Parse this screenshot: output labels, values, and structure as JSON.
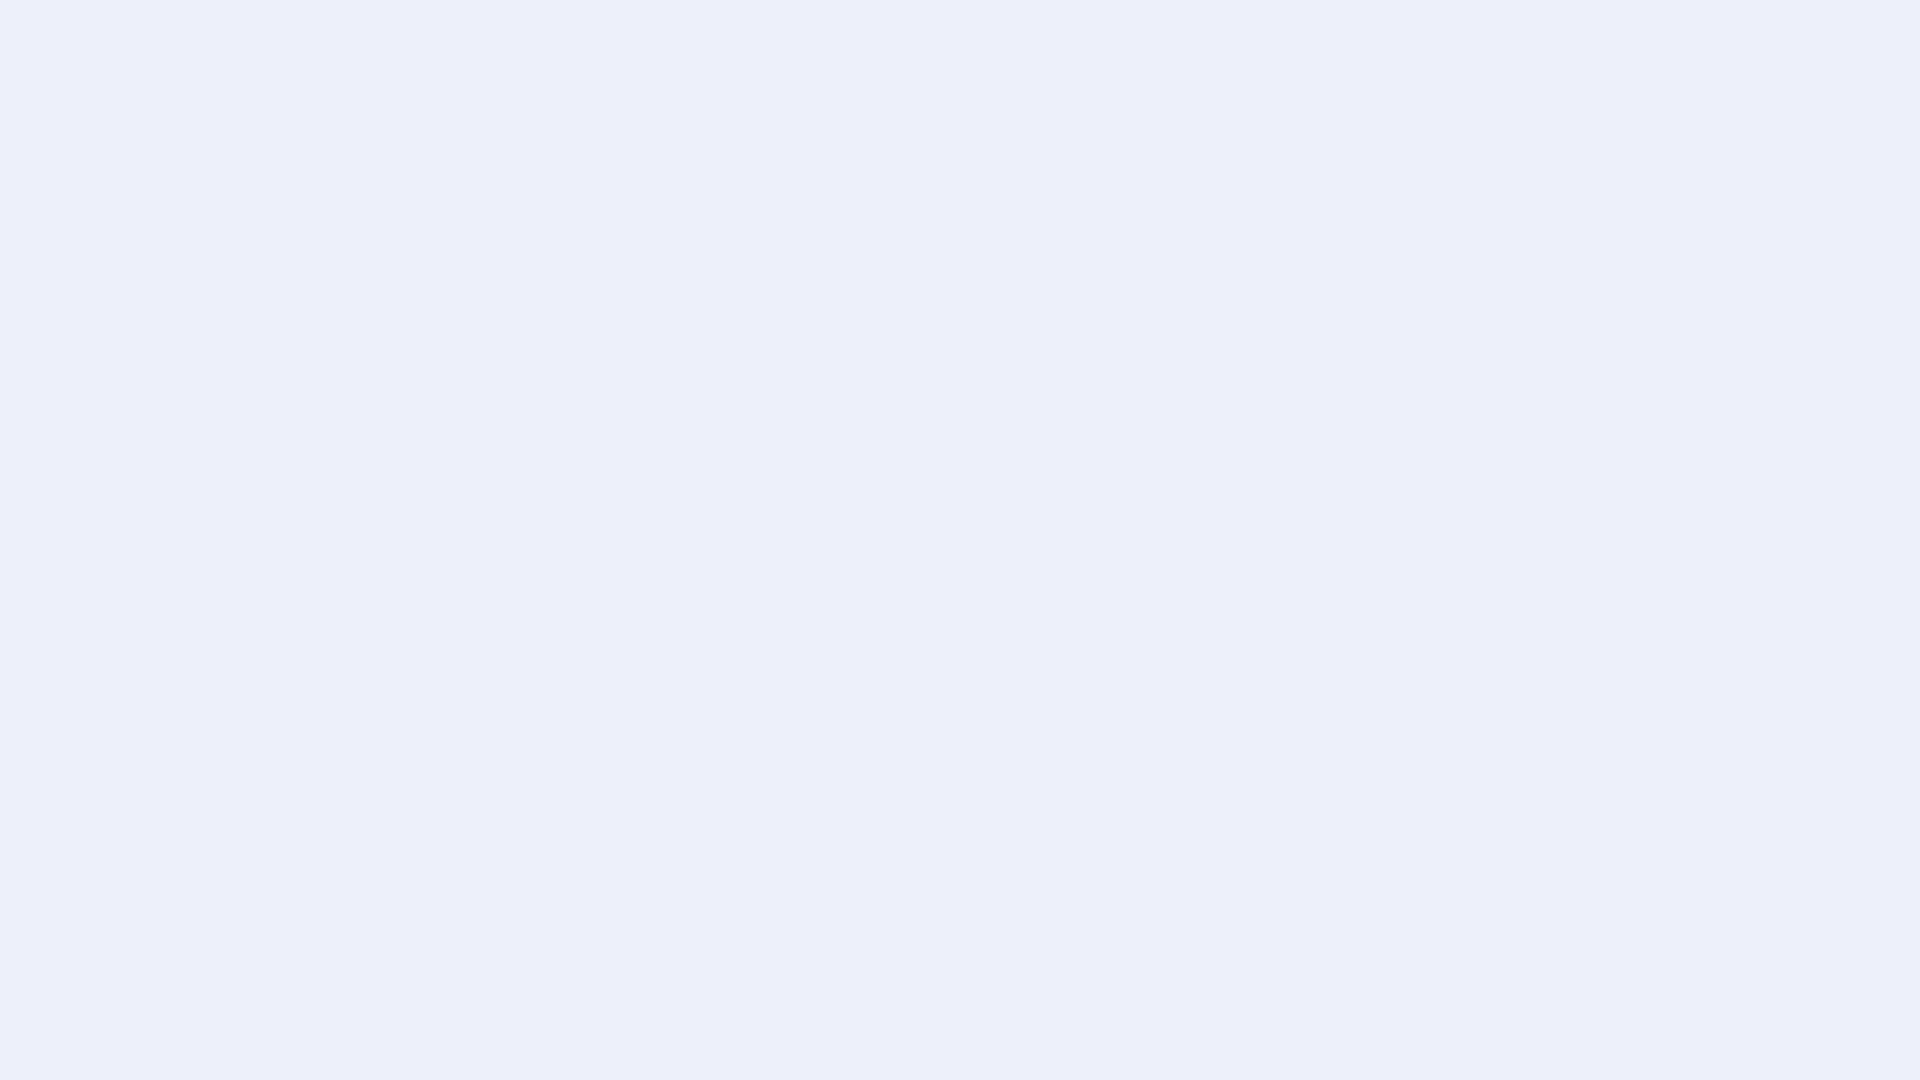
{
  "meta": {
    "title": "Isometric 3D floor plan render of a studio apartment with balcony",
    "background": "#edf0fa",
    "canvas": {
      "width": 1920,
      "height": 1080
    }
  },
  "scene": {
    "rooms": [
      {
        "name": "entry-bathroom"
      },
      {
        "name": "kitchen"
      },
      {
        "name": "dining-area"
      },
      {
        "name": "living-sleeping-area"
      },
      {
        "name": "balcony"
      }
    ],
    "furniture": [
      "bathroom-door",
      "vanity",
      "shower-glass",
      "washing-machine-nook",
      "kitchen-tall-cabinet",
      "kitchen-counter",
      "sink",
      "cooktop",
      "oven",
      "open-shelf",
      "wardrobe",
      "dining-table",
      "dining-chair",
      "sofa-bench",
      "bed",
      "tv",
      "tv-stand",
      "record-player",
      "speaker-sphere",
      "glass-partition",
      "plywood-screen",
      "balcony-railing",
      "potted-plants",
      "hanging-ivy",
      "lounge-chair",
      "side-stool"
    ],
    "palette": {
      "bg": "#edf0fa",
      "shadow": "#bcc2d4",
      "wallCap": "#9ca0a7",
      "wallCapLight": "#b0b4ba",
      "wallOuterNW": "#b8bbc1",
      "wallOuterSW1": "#b2b6bc",
      "wallOuterSW2": "#999da5",
      "wallIn1": "#f6f7f9",
      "wallIn2": "#e9ebef",
      "wallStub": "#d9dce1",
      "grayStub1": "#aaadb3",
      "grayStub2": "#92969c",
      "grayStub3": "#85898f",
      "marble1": "#f1f3f5",
      "marble2": "#e6e9ec",
      "marbleVein": "#d3d8dd",
      "floorWood1": "#d7c2a7",
      "floorWood2": "#c2ab8e",
      "plankLine": "#b1987a",
      "floorBath": "#f0f2f4",
      "bathSeam": "#dde0e4",
      "floorBalcony": "#e9e7e1",
      "balconySeam": "#d7d4cd",
      "doorWhite": "#fafbfc",
      "doorFrame": "#dde0e5",
      "handle": "#7a7f86",
      "tallBeigeSW": "#cdb9a1",
      "tallBeigeSE": "#b5a089",
      "drawerDark": "#675b4f",
      "counterFront": "#8f7e70",
      "counterSide": "#7a6a5d",
      "counterKick": "#685c50",
      "counterTop": "#f3f3f0",
      "counterEdge": "#e3e2dd",
      "sinkRim": "#e9eae7",
      "sinkBowl": "#d3d5d2",
      "faucet": "#3a3d41",
      "cooktop": "#17181a",
      "burner": "#4a4d52",
      "ovenFrame": "#75624f",
      "ovenGlass": "#25211e",
      "ovenHandle": "#d9cab8",
      "applianceBlack": "#232426",
      "shelfWhite": "#f5f6f8",
      "tealCup": "#458f94",
      "amberBowl": "#c98e52",
      "flowerPink": "#d9949b",
      "whiteTop": "#f7f8f9",
      "whiteSW": "#efF1f3",
      "whiteSE": "#e1e4e8",
      "wardFront1": "#f1ece9",
      "wardFront2": "#c9b2a5",
      "wardFront3": "#a78c7f",
      "wardSide": "#8b7464",
      "wardSeam": "#b49c8f",
      "tvBlack": "#141519",
      "tvSky": "#c9d5db",
      "tvGreen": "#7ba061",
      "tvGreenDark": "#52714a",
      "standBody": "#c8c9cd",
      "standBodyDark": "#b5b7bc",
      "standWoodTop": "#c6af8f",
      "standWoodEdge": "#a98f6e",
      "recess": "#332f2a",
      "bookRed": "#8c3a2e",
      "bookWhite": "#ece8e1",
      "speaker": "#212327",
      "tableTop": "#d8d4c9",
      "tableEdge": "#c5c1b5",
      "woodLeg": "#c2a176",
      "chairGray": "#a4a7ab",
      "chairGrayDark": "#94979c",
      "chairWood": "#b98e5f",
      "sofaBase": "#d8d0d3",
      "sofaCushion": "#e6dee1",
      "sofaPink": "#d7c9cf",
      "sideBlock": "#c7b9b0",
      "sideBlockDark": "#a3948a",
      "bedWood1": "#d3bfa2",
      "bedWood2": "#c0aa8c",
      "bedWood3": "#ae977a",
      "mattress": "#ebecee",
      "duvet": "#e0e2e5",
      "duvetShade": "#cfd2d6",
      "foldLine": "#c3c7cc",
      "blanket": "#c8b699",
      "blanketLight": "#efede7",
      "pillowGray": "#d5d7da",
      "pillowDark": "#8b7f71",
      "glass": "#dfeaf2",
      "plywood": "#b4a585",
      "plywoodDark": "#9c8e70",
      "speckle": "#857a5f",
      "parapetWood": "#cfc4a9",
      "railWhite": "#f4f6f8",
      "railPost": "#e9ecef",
      "mesh": "#cdd1d7",
      "green1": "#4e6f45",
      "green2": "#638756",
      "green3": "#7da26d",
      "green4": "#9ebd8e",
      "greenVar": "#c7d6bb",
      "potBlue": "#6fa3b8",
      "potBlueTop": "#55869c",
      "leather": "#4a423c",
      "stoolWood": "#d2bf9c",
      "trayBlack": "#232528",
      "bookBlue": "#5b87a8"
    }
  }
}
